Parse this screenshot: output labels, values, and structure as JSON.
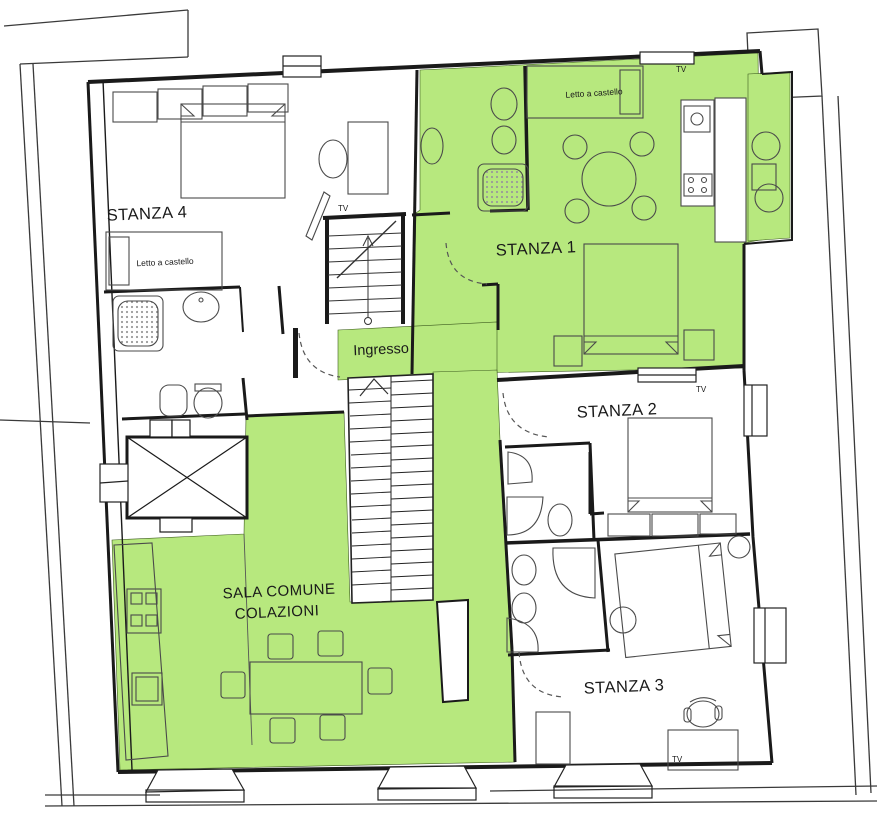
{
  "plan": {
    "type": "apartment-floor-plan",
    "highlighted_rooms": [
      "STANZA 1",
      "SALA COMUNE COLAZIONI",
      "Ingresso"
    ]
  },
  "colors": {
    "highlight": "#b7e87e",
    "wall": "#1a1a1a",
    "furniture": "#4a4a4a",
    "background": "#ffffff"
  },
  "rooms": [
    {
      "id": "stanza4",
      "label": "STANZA 4",
      "highlighted": false
    },
    {
      "id": "stanza1",
      "label": "STANZA 1",
      "highlighted": true
    },
    {
      "id": "stanza2",
      "label": "STANZA 2",
      "highlighted": false
    },
    {
      "id": "stanza3",
      "label": "STANZA 3",
      "highlighted": false
    },
    {
      "id": "sala-comune",
      "label_line1": "SALA COMUNE",
      "label_line2": "COLAZIONI",
      "highlighted": true
    },
    {
      "id": "ingresso",
      "label": "Ingresso",
      "highlighted": true
    }
  ],
  "annotations": {
    "tv_label": "TV",
    "bunk_bed_label": "Letto a castello"
  }
}
